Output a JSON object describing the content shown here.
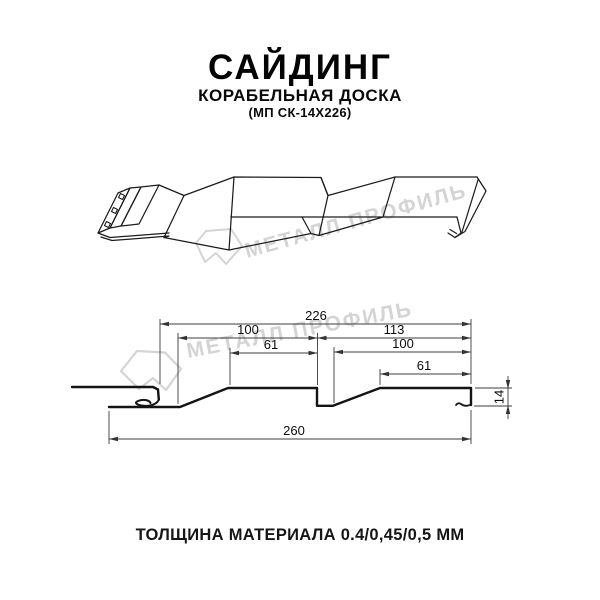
{
  "header": {
    "title": "САЙДИНГ",
    "subtitle": "КОРАБЕЛЬНАЯ ДОСКА",
    "model": "(МП СК-14Х226)"
  },
  "watermark": {
    "text": "МЕТАЛЛ ПРОФИЛЬ",
    "color": "#d4d4d4"
  },
  "section": {
    "dim_total_top": "226",
    "dim_left_pitch": "100",
    "dim_left_flat": "61",
    "dim_right_span": "113",
    "dim_right_pitch": "100",
    "dim_right_flat": "61",
    "dim_total_bottom": "260",
    "dim_height": "14"
  },
  "footer": {
    "thickness": "ТОЛЩИНА МАТЕРИАЛА 0.4/0,45/0,5 ММ"
  },
  "colors": {
    "profile_line": "#141414",
    "drawing_line": "#1c1c1c",
    "dimension_line": "#3c3c3c"
  }
}
